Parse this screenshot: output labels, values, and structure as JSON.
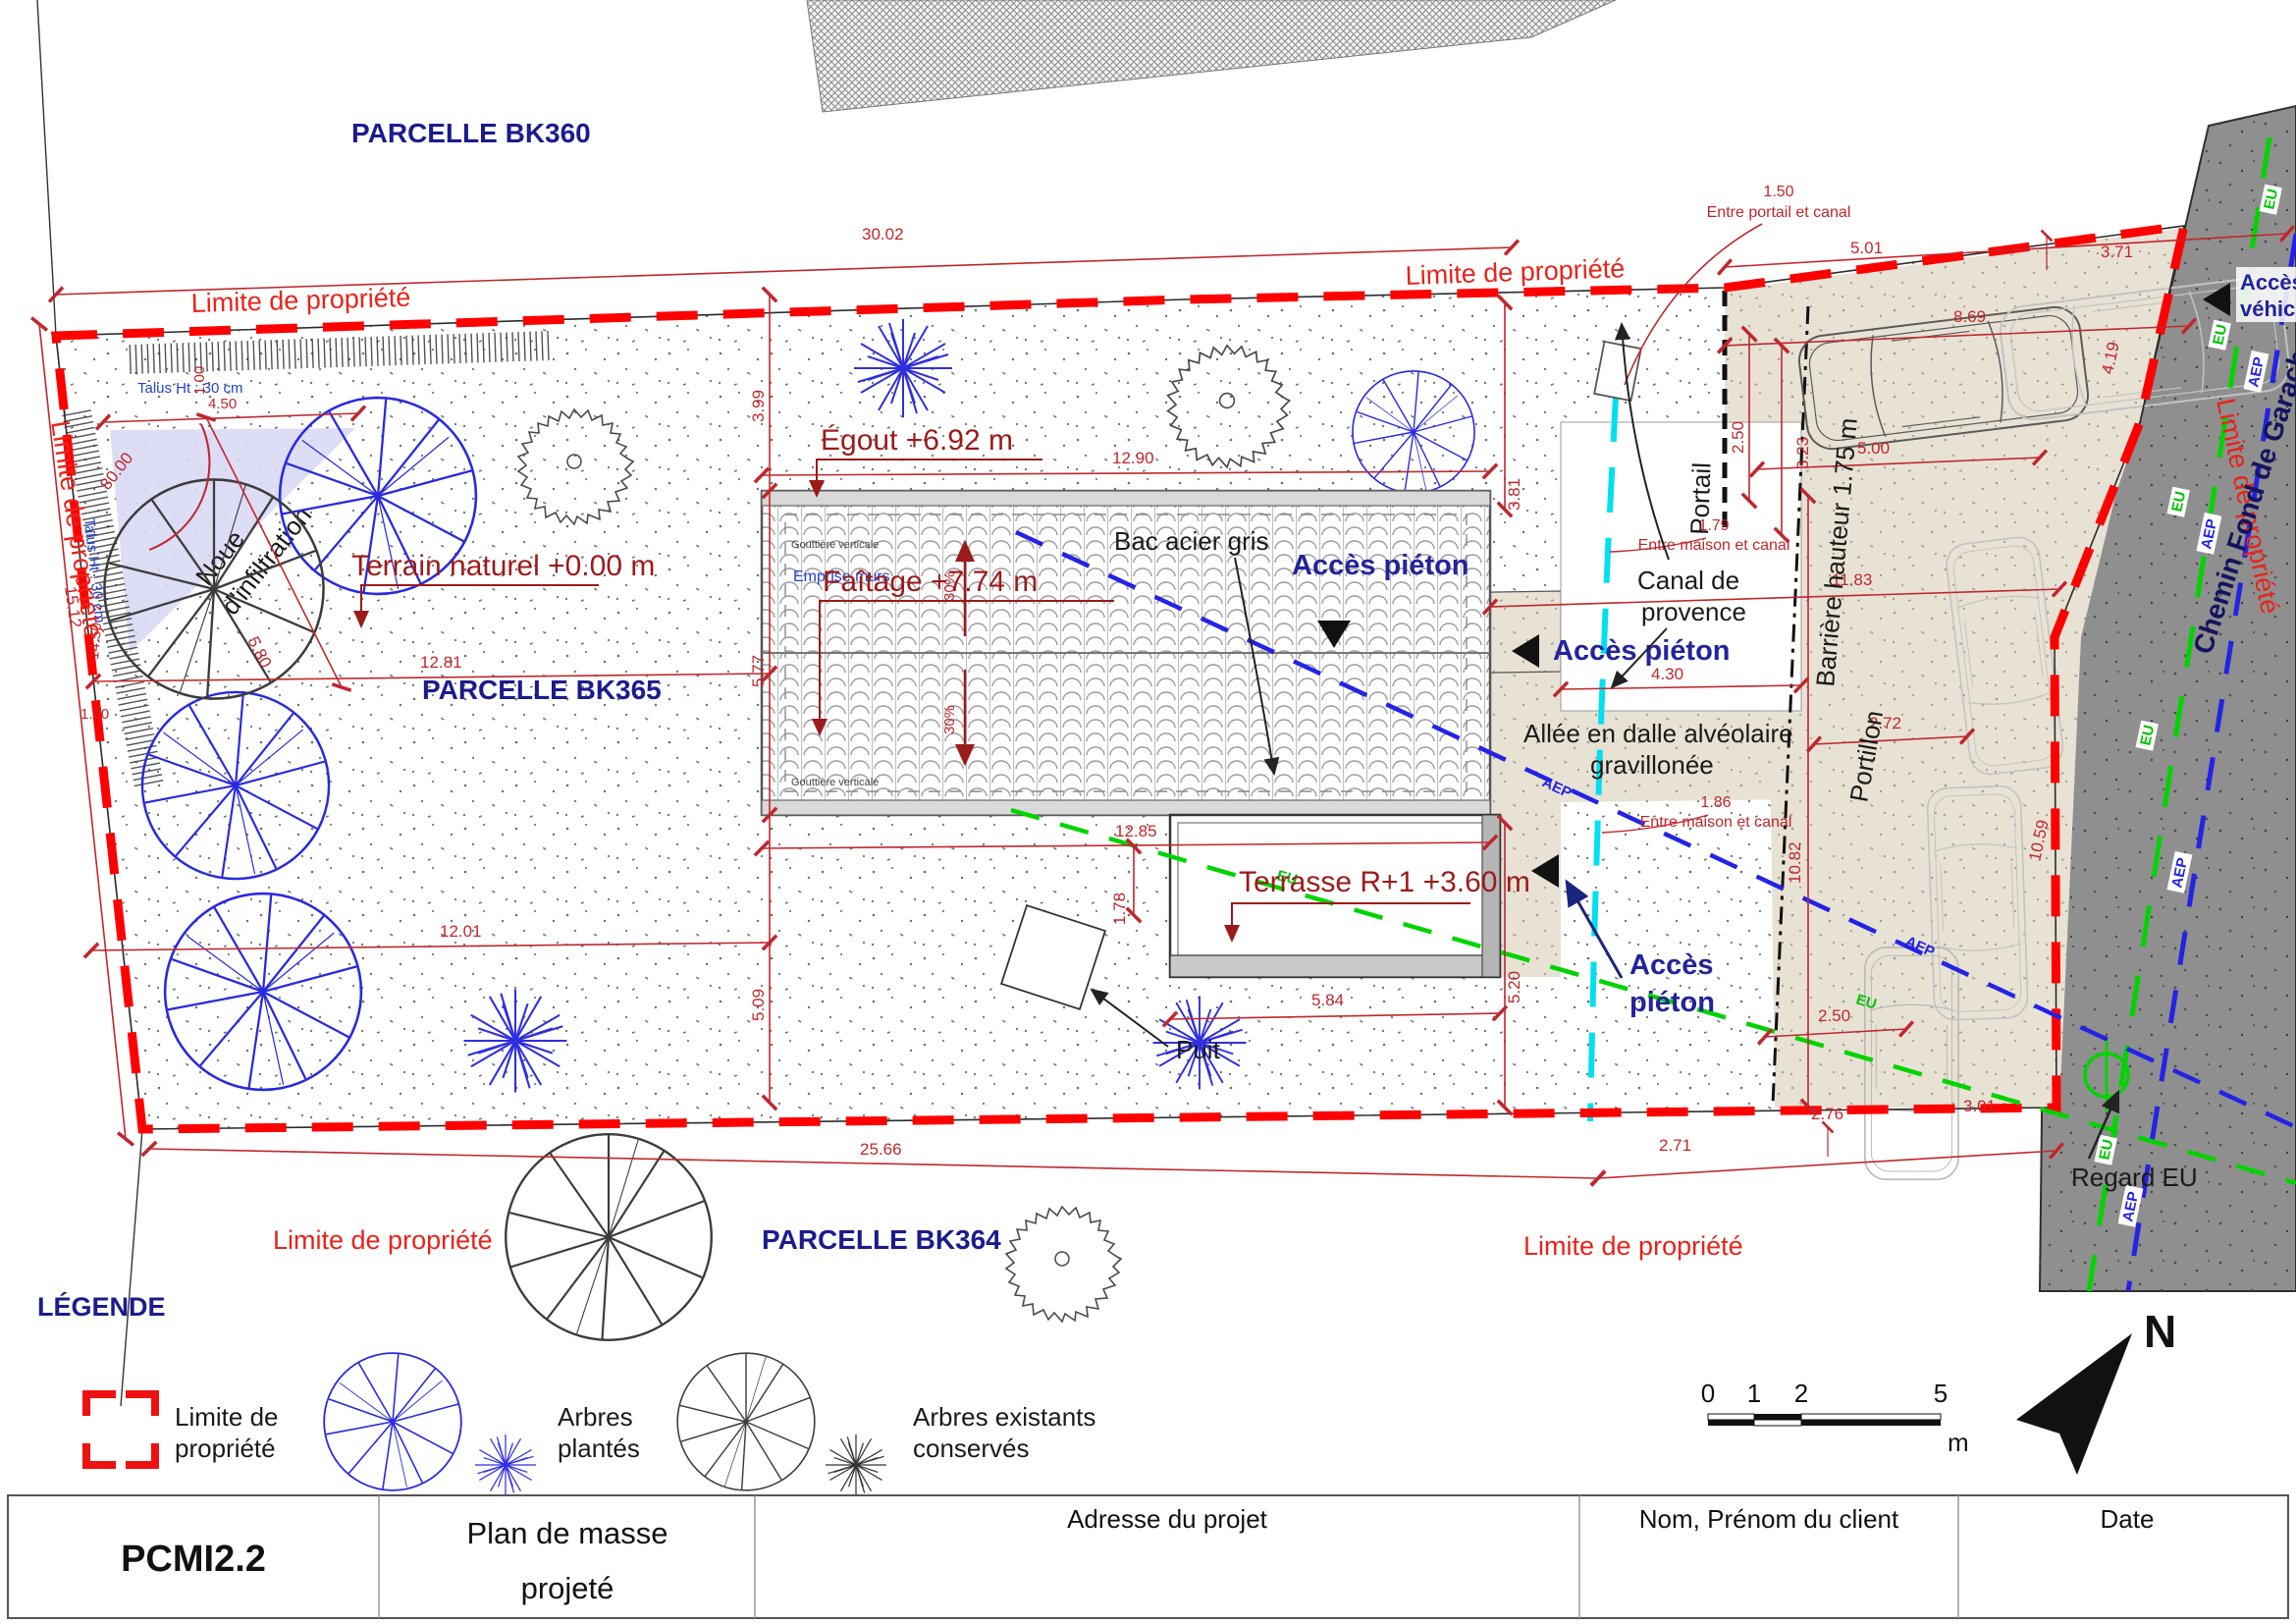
{
  "parcels": {
    "bk360": "PARCELLE BK360",
    "bk365": "PARCELLE BK365",
    "bk364": "PARCELLE BK364"
  },
  "boundary": {
    "label": "Limite de propriété",
    "color": "#ff0000"
  },
  "labels": {
    "terrain": "Terrain naturel +0.00 m",
    "egout": "Égout +6.92 m",
    "faitage": "Faîtage +7.74 m",
    "terrasse": "Terrasse R+1 +3.60 m",
    "bac_acier": "Bac acier gris",
    "acces_pieton": "Accès piéton",
    "acces_pieton2": [
      "Accès",
      "piéton"
    ],
    "acces_vehicules": [
      "Accès",
      "véhicules"
    ],
    "canal": [
      "Canal de",
      "provence"
    ],
    "allee": [
      "Allée en dalle alvéolaire",
      "gravillonée"
    ],
    "barriere": "Barrière hauteur 1.75 m",
    "portail": "Portail",
    "portillon": "Portillon",
    "puit": "Puit",
    "regard_eu": "Regard EU",
    "noue": [
      "Noue",
      "d'infiltration"
    ],
    "chemin": "Chemin Fond de Garach",
    "emprise_murs": "Emprise murs",
    "gouttiere": "Gouttière verticale",
    "talus": "Talus Ht : 30 cm",
    "slope": "30%",
    "eu": "EU",
    "aep": "AEP"
  },
  "notes": {
    "portail_canal": [
      "1.50",
      "Entre portail et canal"
    ],
    "maison_canal_1": [
      "1.79",
      "Entre maison et canal"
    ],
    "maison_canal_2": [
      "1.86",
      "Entre maison et canal"
    ]
  },
  "dims": {
    "top": "30.02",
    "seg1": "5.01",
    "seg2": "3.71",
    "park_w": "8.69",
    "car_w": "2.50",
    "car_gap": "3.23",
    "car_l": "5.00",
    "drive_top": "11.83",
    "right_v1": "3.81",
    "left_v1": "3.99",
    "left_v2": "5.77",
    "left_v3": "5.09",
    "mid1": "12.81",
    "mid2": "12.01",
    "roof_w": "12.90",
    "roof_b": "12.85",
    "terr_off": "1.78",
    "terr_w": "5.84",
    "terr_r": "5.20",
    "bottom": "25.66",
    "b1": "2.71",
    "b2": "2.76",
    "b3": "3.01",
    "corridor": "4.30",
    "portillon_w": "2.72",
    "drive_l": "10.82",
    "road1": "10.59",
    "road2": "4.19",
    "car_w2": "2.50",
    "angle": "80.00",
    "talus_w": "4.50",
    "one_a": "1.00",
    "talus_h": "14.50",
    "one_b": "1.00",
    "left_len": "15.12",
    "noue_l": "5.80"
  },
  "legend": {
    "title": "LÉGENDE",
    "item_limite": [
      "Limite de",
      "propriété"
    ],
    "item_plantes": [
      "Arbres",
      "plantés"
    ],
    "item_existants": [
      "Arbres existants",
      "conservés"
    ]
  },
  "scale_bar": {
    "t0": "0",
    "t1": "1",
    "t2": "2",
    "t5": "5",
    "unit": "m"
  },
  "north": "N",
  "title_block": {
    "code": "PCMI2.2",
    "title_line1": "Plan de masse",
    "title_line2": "projeté",
    "adresse": "Adresse du projet",
    "client": "Nom, Prénom du client",
    "date": "Date"
  },
  "colors": {
    "boundary_red": "#ff0000",
    "dim_red": "#c0272d",
    "maroon": "#9b1b1b",
    "parcel_blue": "#1b1b8f",
    "beige": "#e8e2d4",
    "road_gray": "#8f8f8f",
    "canal_cyan": "#00e0f0",
    "eu_green": "#00d400",
    "aep_blue": "#2323e6",
    "noue_lavender": "#d9d9f5"
  }
}
